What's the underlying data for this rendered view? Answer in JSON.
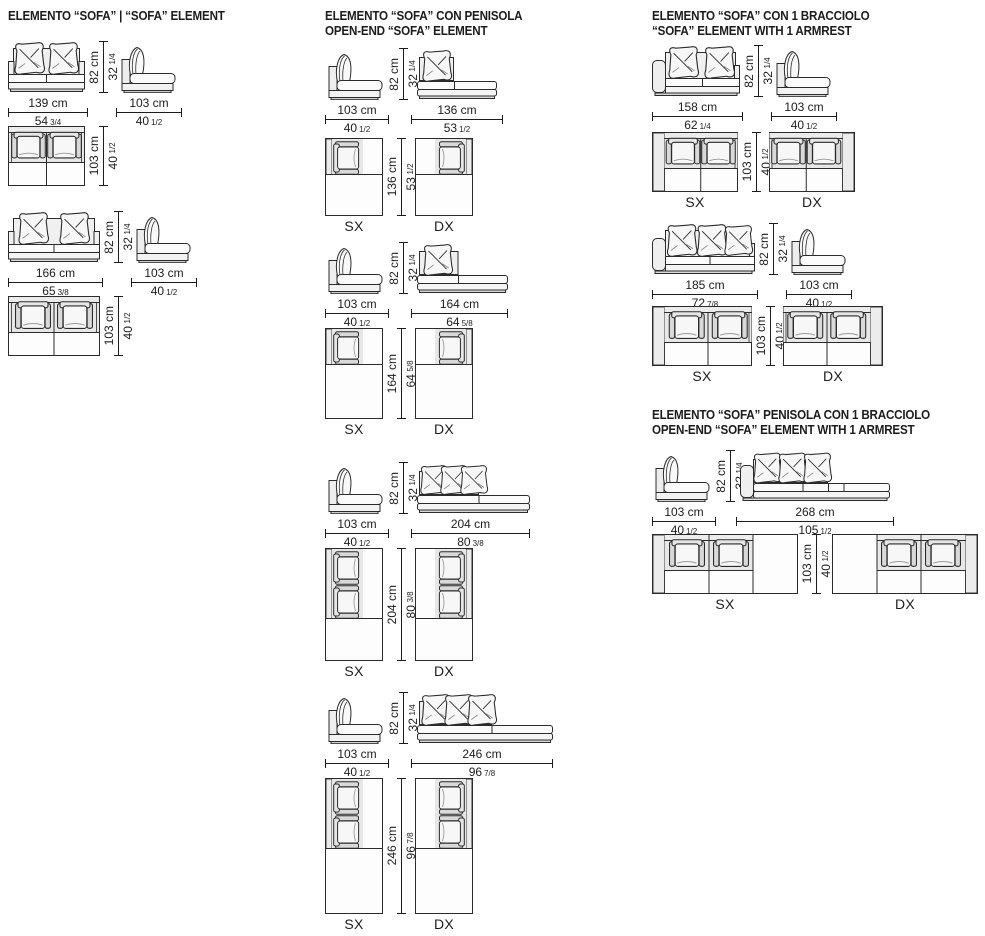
{
  "page": {
    "background": "#ffffff",
    "ink": "#1c1c1c"
  },
  "labels": {
    "sx": "SX",
    "dx": "DX"
  },
  "sections": {
    "left": {
      "title_line1": "ELEMENTO “SOFA” | “SOFA” ELEMENT",
      "title_line2": "",
      "groups": {
        "g1": {
          "front_w_cm": "139 cm",
          "front_w_in": "54",
          "front_w_frac": "3/4",
          "h_cm": "82 cm",
          "h_in": "32",
          "h_frac": "1/4",
          "side_w_cm": "103 cm",
          "side_w_in": "40",
          "side_w_frac": "1/2",
          "top_d_cm": "103 cm",
          "top_d_in": "40",
          "top_d_frac": "1/2"
        },
        "g2": {
          "front_w_cm": "166 cm",
          "front_w_in": "65",
          "front_w_frac": "3/8",
          "h_cm": "82 cm",
          "h_in": "32",
          "h_frac": "1/4",
          "side_w_cm": "103 cm",
          "side_w_in": "40",
          "side_w_frac": "1/2",
          "top_d_cm": "103 cm",
          "top_d_in": "40",
          "top_d_frac": "1/2"
        }
      }
    },
    "middle": {
      "title_line1": "ELEMENTO “SOFA” CON PENISOLA",
      "title_line2": "OPEN-END “SOFA” ELEMENT",
      "groups": {
        "g1": {
          "side_w_cm": "103 cm",
          "side_w_in": "40",
          "side_w_frac": "1/2",
          "h_cm": "82 cm",
          "h_in": "32",
          "h_frac": "1/4",
          "front_w_cm": "136 cm",
          "front_w_in": "53",
          "front_w_frac": "1/2",
          "top_d_cm": "136 cm",
          "top_d_in": "53",
          "top_d_frac": "1/2"
        },
        "g2": {
          "side_w_cm": "103 cm",
          "side_w_in": "40",
          "side_w_frac": "1/2",
          "h_cm": "82 cm",
          "h_in": "32",
          "h_frac": "1/4",
          "front_w_cm": "164 cm",
          "front_w_in": "64",
          "front_w_frac": "5/8",
          "top_d_cm": "164 cm",
          "top_d_in": "64",
          "top_d_frac": "5/8"
        },
        "g3": {
          "side_w_cm": "103 cm",
          "side_w_in": "40",
          "side_w_frac": "1/2",
          "h_cm": "82 cm",
          "h_in": "32",
          "h_frac": "1/4",
          "front_w_cm": "204 cm",
          "front_w_in": "80",
          "front_w_frac": "3/8",
          "top_d_cm": "204 cm",
          "top_d_in": "80",
          "top_d_frac": "3/8"
        },
        "g4": {
          "side_w_cm": "103 cm",
          "side_w_in": "40",
          "side_w_frac": "1/2",
          "h_cm": "82 cm",
          "h_in": "32",
          "h_frac": "1/4",
          "front_w_cm": "246 cm",
          "front_w_in": "96",
          "front_w_frac": "7/8",
          "top_d_cm": "246 cm",
          "top_d_in": "96",
          "top_d_frac": "7/8"
        }
      }
    },
    "right": {
      "title_line1": "ELEMENTO “SOFA” CON 1 BRACCIOLO",
      "title_line2": "“SOFA” ELEMENT WITH 1 ARMREST",
      "groups": {
        "g1": {
          "front_w_cm": "158 cm",
          "front_w_in": "62",
          "front_w_frac": "1/4",
          "h_cm": "82 cm",
          "h_in": "32",
          "h_frac": "1/4",
          "side_w_cm": "103 cm",
          "side_w_in": "40",
          "side_w_frac": "1/2",
          "top_d_cm": "103 cm",
          "top_d_in": "40",
          "top_d_frac": "1/2"
        },
        "g2": {
          "front_w_cm": "185 cm",
          "front_w_in": "72",
          "front_w_frac": "7/8",
          "h_cm": "82 cm",
          "h_in": "32",
          "h_frac": "1/4",
          "side_w_cm": "103 cm",
          "side_w_in": "40",
          "side_w_frac": "1/2",
          "top_d_cm": "103 cm",
          "top_d_in": "40",
          "top_d_frac": "1/2"
        }
      }
    },
    "right_bottom": {
      "title_line1": "ELEMENTO “SOFA” PENISOLA CON 1 BRACCIOLO",
      "title_line2": "OPEN-END “SOFA” ELEMENT WITH 1 ARMREST",
      "groups": {
        "g1": {
          "side_w_cm": "103 cm",
          "side_w_in": "40",
          "side_w_frac": "1/2",
          "h_cm": "82 cm",
          "h_in": "32",
          "h_frac": "1/4",
          "front_w_cm": "268 cm",
          "front_w_in": "105",
          "front_w_frac": "1/2",
          "top_d_cm": "103 cm",
          "top_d_in": "40",
          "top_d_frac": "1/2"
        }
      }
    }
  }
}
